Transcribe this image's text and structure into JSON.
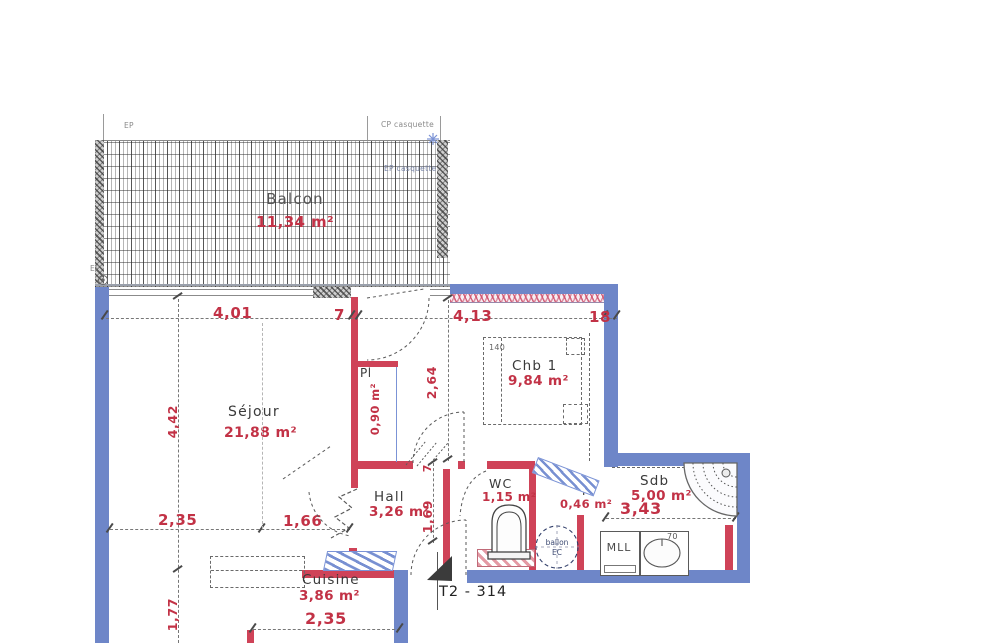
{
  "title": "T2 - 314",
  "balcony": {
    "name": "Balcon",
    "area": "11,34 m²"
  },
  "rooms": {
    "sejour": {
      "name": "Séjour",
      "area": "21,88 m²"
    },
    "chb1": {
      "name": "Chb 1",
      "area": "9,84 m²"
    },
    "hall": {
      "name": "Hall",
      "area": "3,26 m²"
    },
    "wc": {
      "name": "WC",
      "area": "1,15 m²"
    },
    "sdb": {
      "name": "Sdb",
      "area": "5,00 m²"
    },
    "cuisine": {
      "name": "Cuisine",
      "area": "3,86 m²"
    },
    "pl_sejour": {
      "name": "Pl",
      "area": "0,90 m²"
    },
    "pl_sdb": {
      "name": "Pl",
      "area": "0,46 m²"
    }
  },
  "dims": {
    "top_1": "4,01",
    "top_2": "7",
    "top_3": "4,13",
    "top_4": "18",
    "left_1": "4,42",
    "left_2": "1,77",
    "mid_1": "2,35",
    "mid_2": "1,66",
    "bottom_1": "2,35",
    "chb1_depth": "2,64",
    "hall_thickness": "7",
    "hall_height": "1,69",
    "sdb_width": "3,43"
  },
  "fixtures": {
    "bed_width": "140",
    "washer": "MLL",
    "sink_width": "70",
    "heater_line1": "ballon",
    "heater_line2": "EC"
  },
  "annotations": {
    "ep_top": "EP",
    "cp_casquette": "CP casquette",
    "ep_casquette": "EP casquette",
    "ep_bottom": "EP"
  },
  "colors": {
    "blue": "#6e86c8",
    "red": "#cf4358",
    "dim": "#c23246"
  }
}
